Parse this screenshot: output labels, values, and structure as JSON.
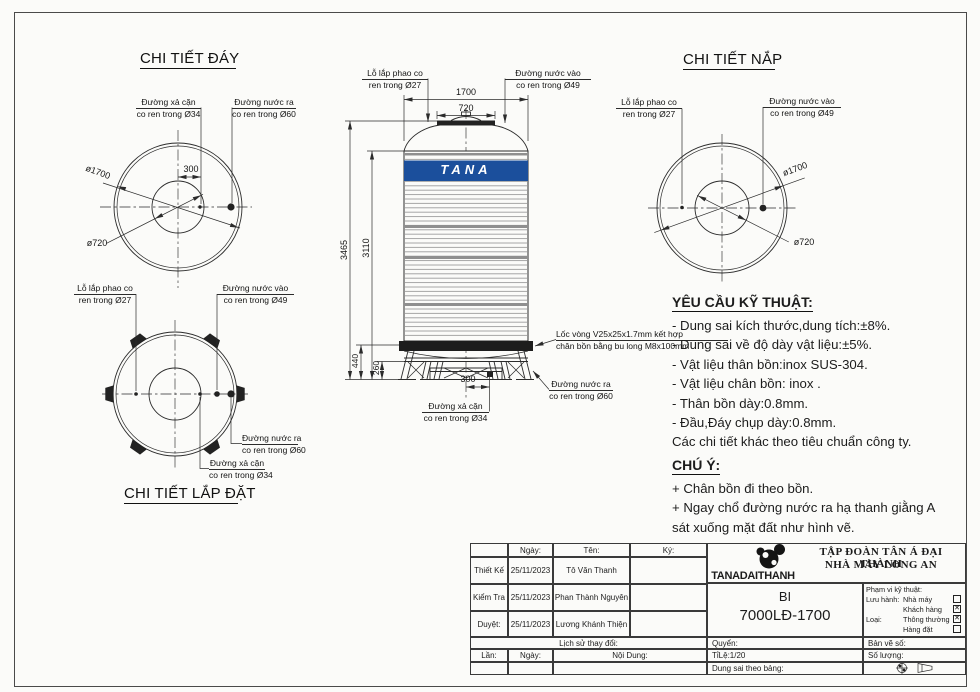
{
  "sheet": {
    "bg": "#fbfbf9",
    "line_color": "#2b2b2b",
    "accent_blue": "#1b4f9c"
  },
  "details": {
    "day": {
      "title": "CHI TIẾT ĐÁY"
    },
    "lapdat": {
      "title": "CHI TIẾT LẮP ĐẶT"
    },
    "nap": {
      "title": "CHI TIẾT NẮP"
    }
  },
  "callouts": {
    "xa_can": {
      "l1": "Đường xả cặn",
      "l2": "co ren trong Ø34"
    },
    "nuoc_ra": {
      "l1": "Đường nước ra",
      "l2": "co ren trong Ø60"
    },
    "nuoc_vao": {
      "l1": "Đường nước vào",
      "l2": "co ren trong Ø49"
    },
    "phao": {
      "l1": "Lỗ lắp phao co",
      "l2": "ren trong Ø27"
    },
    "loc_vong": {
      "l1": "Lốc vòng V25x25x1.7mm kết hợp",
      "l2": "chân bồn bằng bu long M8x100mm"
    }
  },
  "dims": {
    "w1700": "1700",
    "w720": "720",
    "h3465": "3465",
    "h3110": "3110",
    "h440": "440",
    "h260": "260",
    "off300": "300",
    "dia1700": "ø1700",
    "dia720": "ø720"
  },
  "tank": {
    "brand": "TANA"
  },
  "tech": {
    "heading": "YÊU CẦU KỸ THUẬT:",
    "items": [
      "- Dung sai kích thước,dung tích:±8%.",
      "- Dung sai về độ dày vật liệu:±5%.",
      "- Vật liệu thân bồn:inox SUS-304.",
      "- Vật liệu chân bồn: inox .",
      "- Thân bồn dày:0.8mm.",
      "- Đầu,Đáy chụp dày:0.8mm.",
      "Các chi tiết khác theo tiêu chuẩn công ty."
    ],
    "note_heading": "CHÚ Ý:",
    "notes": [
      "+ Chân bồn đi theo bồn.",
      "+ Ngay chổ đường nước ra hạ thanh giằng A",
      "sát xuống mặt đất như hình vẽ."
    ]
  },
  "titleblock": {
    "col_date": "Ngày:",
    "col_name": "Tên:",
    "col_sign": "Ký:",
    "rows": [
      {
        "role": "Thiết Kế",
        "date": "25/11/2023",
        "name": "Tô Văn Thanh"
      },
      {
        "role": "Kiểm Tra",
        "date": "25/11/2023",
        "name": "Phan Thành Nguyên"
      },
      {
        "role": "Duyệt:",
        "date": "25/11/2023",
        "name": "Lương Khánh Thiện"
      }
    ],
    "history": "Lịch sử thay đổi:",
    "rev": "Lần:",
    "rev_date": "Ngày:",
    "content": "Nội Dung:",
    "company1": "TẬP ĐOÀN TÂN Á ĐẠI THÀNH",
    "company2": "NHÀ MÁY LONG AN",
    "logo": "TANADAITHANH",
    "code1": "BI",
    "code2": "7000LĐ-1700",
    "scope_title": "Phạm vi kỹ thuật:",
    "scope_rows": [
      {
        "prefix": "Lưu hành:",
        "label": "Nhà máy",
        "mark": ""
      },
      {
        "prefix": "",
        "label": "Khách hàng",
        "mark": "✕"
      },
      {
        "prefix": "Loại:",
        "label": "Thông thường",
        "mark": "✕"
      },
      {
        "prefix": "",
        "label": "Hàng đặt",
        "mark": ""
      }
    ],
    "quyen": "Quyển:",
    "ban_ve_so": "Bản vẽ số:",
    "ti_le": "TỉLệ:1/20",
    "so_luong": "Số lượng:",
    "dung_sai": "Dung sai theo bảng:"
  }
}
